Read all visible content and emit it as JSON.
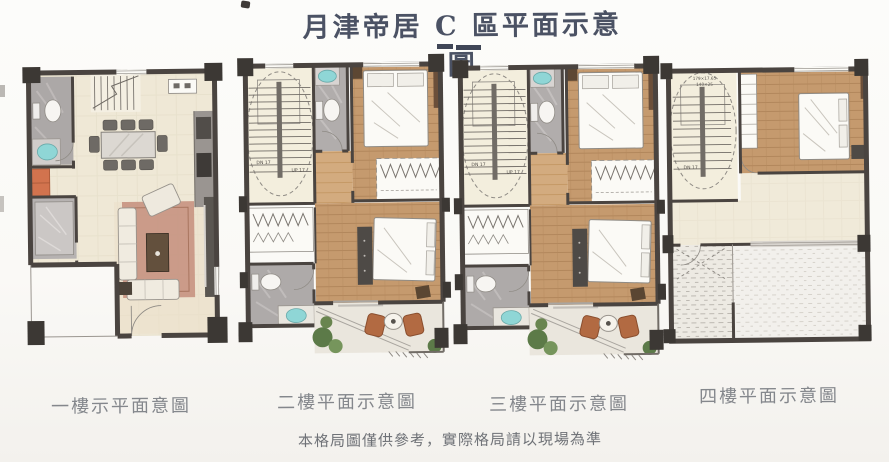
{
  "title": "月津帝居 C 區平面示意圖",
  "disclaimer": "本格局圖僅供參考，實際格局請以現場為準",
  "plans": [
    {
      "id": "floor-1",
      "label": "一樓示平面意圖"
    },
    {
      "id": "floor-2",
      "label": "二樓平面示意圖",
      "stair_down": "DN 17",
      "stair_up": "UP 17"
    },
    {
      "id": "floor-3",
      "label": "三樓平面示意圖",
      "stair_down": "DN 17",
      "stair_up": "UP 17"
    },
    {
      "id": "floor-4",
      "label": "四樓平面示意圖",
      "stair_down": "DN 17",
      "stair_dim_1": "179×17.65",
      "stair_dim_2": "140×25"
    }
  ],
  "colors": {
    "title_ink": "#4b5264",
    "label_ink": "#84878c",
    "wall": "#4a4440",
    "column": "#3c3834",
    "tile_cream": "#efe8d6",
    "wood": "#c59a6e",
    "marble_gray": "#aeaaa9",
    "sink_teal": "#8fd6d6",
    "plant_green": "#5c7a48",
    "chair_rust": "#b26a42",
    "rug": "#c48e7c"
  }
}
